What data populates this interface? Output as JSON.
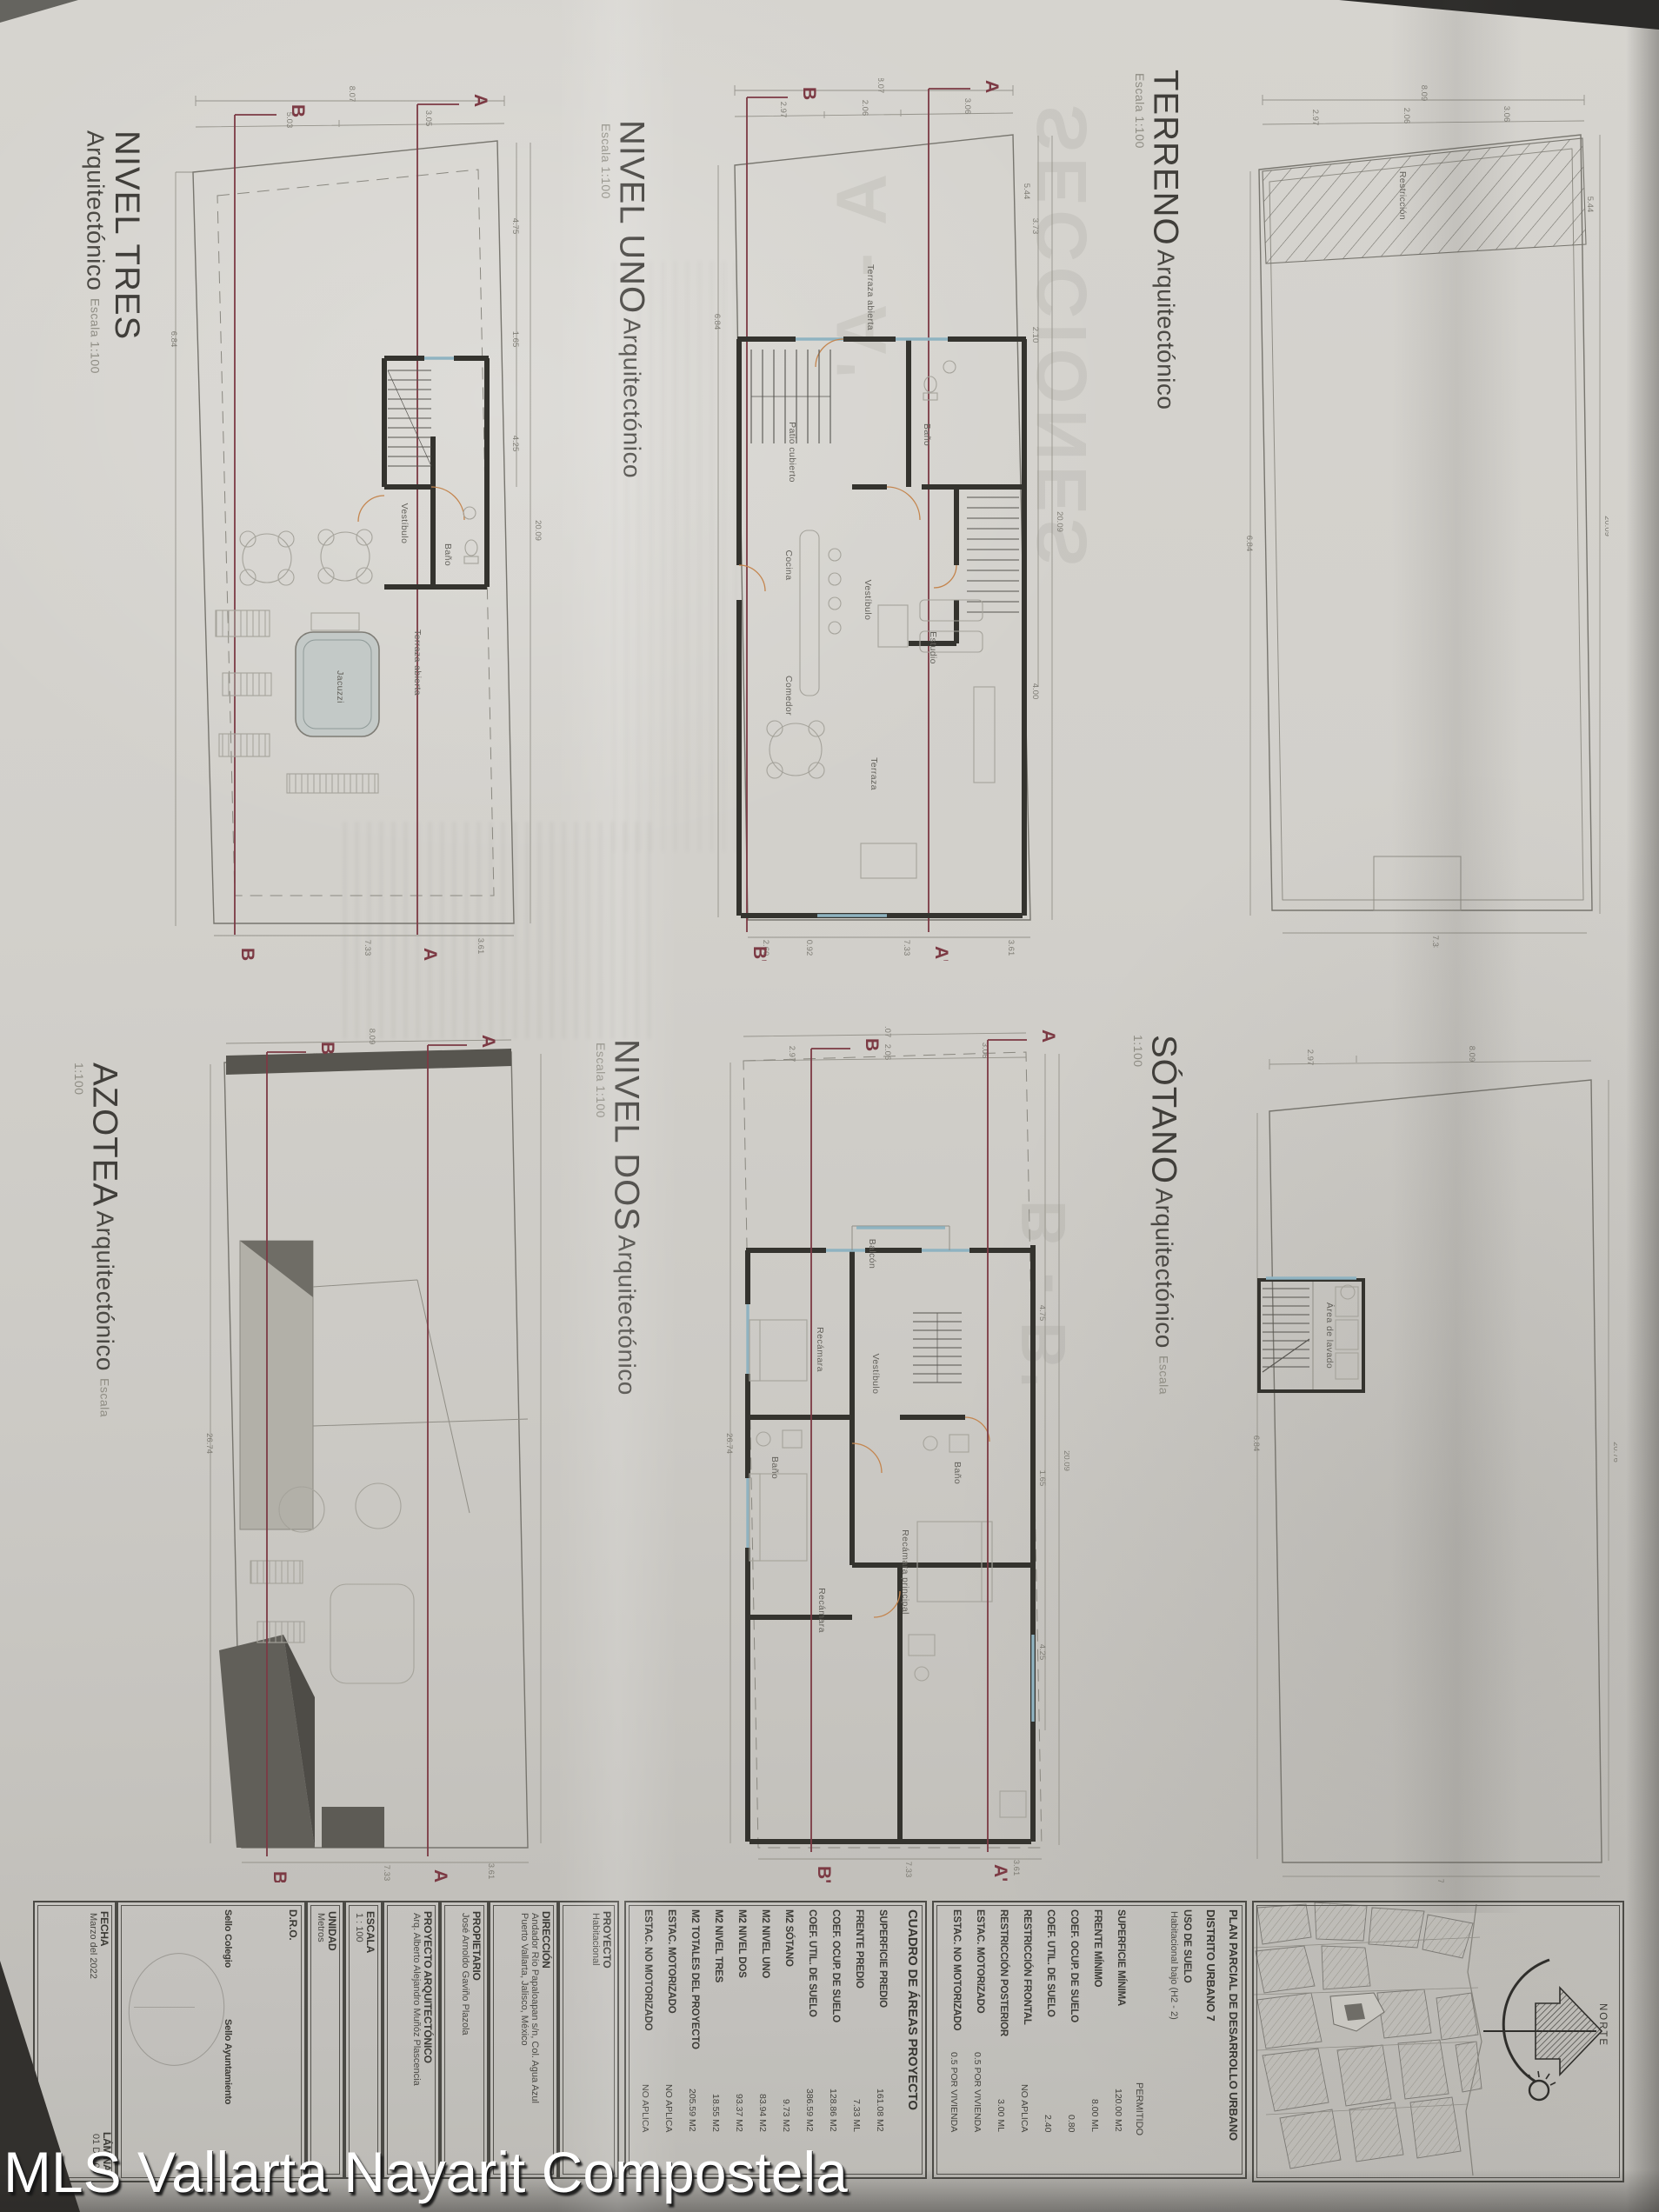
{
  "watermark": "MLS Vallarta Nayarit Compostela",
  "colors": {
    "paper": "#d2d0cb",
    "wall": "#34332e",
    "section": "#7c3a44",
    "window": "#8fb3c1",
    "door": "#c4854e",
    "roof_dark": "#57554f"
  },
  "plans": {
    "nivel_tres": {
      "title": "NIVEL TRES",
      "subtitle": "Arquitectónico",
      "scale": "Escala 1:100",
      "markers": {
        "b": "B",
        "a": "A",
        "b2": "B'",
        "a2": "A'"
      },
      "rooms": {
        "vestibulo": "Vestíbulo",
        "bano": "Baño",
        "terraza": "Terraza abierta",
        "jacuzzi": "Jacuzzi"
      },
      "dims": [
        "8.07",
        "5.03",
        "3.05",
        "6.84",
        "20.09",
        "4.75",
        "1.65",
        "4.25",
        "7.33",
        "3.61"
      ]
    },
    "nivel_uno": {
      "title": "NIVEL UNO",
      "subtitle": "Arquitectónico",
      "scale": "Escala 1:100",
      "markers": {
        "b": "B",
        "a": "A",
        "b2": "B'",
        "a2": "A'"
      },
      "rooms": {
        "terraza": "Terraza abierta",
        "patio": "Patio cubierto",
        "vestibulo": "Vestíbulo",
        "bano": "Baño",
        "cocina": "Cocina",
        "comedor": "Comedor",
        "estudio": "Estudio",
        "terraza2": "Terraza"
      },
      "dims": [
        "8.07",
        "2.97",
        "2.06",
        "3.06",
        "5.44",
        "3.73",
        "2.10",
        "20.09",
        "4.00",
        "2.60",
        "0.92",
        "7.33",
        "3.61",
        "6.84"
      ]
    },
    "terreno": {
      "title": "TERRENO",
      "subtitle": "Arquitectónico",
      "scale": "Escala 1:100",
      "rooms": {
        "restriccion": "Restricción"
      },
      "dims": [
        "8.09",
        "2.97",
        "2.06",
        "3.06",
        "5.44",
        "6.84",
        "20.09",
        "7.33"
      ]
    },
    "azotea": {
      "title": "AZOTEA",
      "subtitle": "Arquitectónico",
      "scale": "Escala 1:100",
      "markers": {
        "b": "B",
        "a": "A",
        "b2": "B'",
        "a2": "A'"
      },
      "dims": [
        "8.09",
        "5.03",
        "3.05",
        "26.74",
        "7.33",
        "3.61"
      ]
    },
    "nivel_dos": {
      "title": "NIVEL DOS",
      "subtitle": "Arquitectónico",
      "scale": "Escala 1:100",
      "markers": {
        "b": "B",
        "a": "A",
        "b2": "B'",
        "a2": "A'"
      },
      "rooms": {
        "balcon": "Balcón",
        "recamara": "Recámara",
        "vestibulo": "Vestíbulo",
        "bano1": "Baño",
        "bano2": "Baño",
        "principal": "Recámara principal",
        "recamara2": "Recámara"
      },
      "dims": [
        "8.07",
        "2.97",
        "2.06",
        "3.06",
        "4.75",
        "20.09",
        "1.65",
        "4.25",
        "26.74",
        "7.33",
        "3.61"
      ]
    },
    "sotano": {
      "title": "SÓTANO",
      "subtitle": "Arquitectónico",
      "scale": "Escala 1:100",
      "rooms": {
        "lavado": "Área de lavado"
      },
      "dims": [
        "2.97",
        "8.09",
        "6.84",
        "20.76",
        "7.33"
      ]
    }
  },
  "titleblock": {
    "fecha_label": "FECHA",
    "fecha_value": "Marzo del 2022",
    "lamina_label": "LÁMINA",
    "lamina_value": "01 DE 06",
    "dro_label": "D.R.O.",
    "sello1": "Sello Colegio",
    "sello2": "Sello Ayuntamiento",
    "unidad_label": "UNIDAD",
    "unidad_value": "Metros",
    "escala_label": "ESCALA",
    "escala_value": "1 : 100",
    "proyecto_arq_label": "PROYECTO ARQUITECTÓNICO",
    "proyecto_arq_value": "Arq. Alberto Alejandro Muñóz Plascencia",
    "propietario_label": "PROPIETARIO",
    "propietario_value": "José Arnoldo Gaviño Plazola",
    "direccion_label": "DIRECCIÓN",
    "direccion_value1": "Andador Río Papaloapan s/n, Col. Agua Azul",
    "direccion_value2": "Puerto Vallarta, Jalisco, México",
    "proyecto_label": "PROYECTO",
    "proyecto_value": "Habitacional",
    "norte_label": "NORTE"
  },
  "cuadro": {
    "title": "CUADRO DE ÁREAS PROYECTO",
    "rows": [
      {
        "label": "SUPERFICIE PREDIO",
        "value": "161.08 M2"
      },
      {
        "label": "FRENTE PREDIO",
        "value": "7.33 ML"
      },
      {
        "label": "COEF. OCUP. DE SUELO",
        "value": "128.86 M2"
      },
      {
        "label": "COEF. UTIL. DE SUELO",
        "value": "386.59 M2"
      },
      {
        "label": "M2 SÓTANO",
        "value": "9.73 M2"
      },
      {
        "label": "M2 NIVEL UNO",
        "value": "83.94 M2"
      },
      {
        "label": "M2 NIVEL DOS",
        "value": "93.37 M2"
      },
      {
        "label": "M2 NIVEL TRES",
        "value": "18.55 M2"
      },
      {
        "label": "M2 TOTALES DEL PROYECTO",
        "value": "205.59 M2"
      },
      {
        "label": "ESTAC. MOTORIZADO",
        "value": "NO APLICA"
      },
      {
        "label": "ESTAC. NO MOTORIZADO",
        "value": "NO APLICA"
      }
    ]
  },
  "plan_parcial": {
    "title1": "PLAN PARCIAL DE DESARROLLO URBANO",
    "title2": "DISTRITO URBANO 7",
    "uso_label": "USO DE SUELO",
    "uso_value": "Habitacional bajo (H2 - 2)",
    "permitido": "PERMITIDO",
    "rows": [
      {
        "label": "SUPERFICIE MÍNIMA",
        "value": "120.00 M2"
      },
      {
        "label": "FRENTE MÍNIMO",
        "value": "8.00 ML"
      },
      {
        "label": "COEF. OCUP. DE SUELO",
        "value": "0.80"
      },
      {
        "label": "COEF. UTIL. DE SUELO",
        "value": "2.40"
      },
      {
        "label": "RESTRICCIÓN FRONTAL",
        "value": "NO APLICA"
      },
      {
        "label": "RESTRICCIÓN POSTERIOR",
        "value": "3.00 ML"
      },
      {
        "label": "ESTAC. MOTORIZADO",
        "value": "0.5 POR VIVIENDA"
      },
      {
        "label": "ESTAC. NO MOTORIZADO",
        "value": "0.5 POR VIVIENDA"
      }
    ]
  },
  "ghosts": {
    "g1": "SECCIONES",
    "g2": "A - A'",
    "g3": "B - B'"
  }
}
